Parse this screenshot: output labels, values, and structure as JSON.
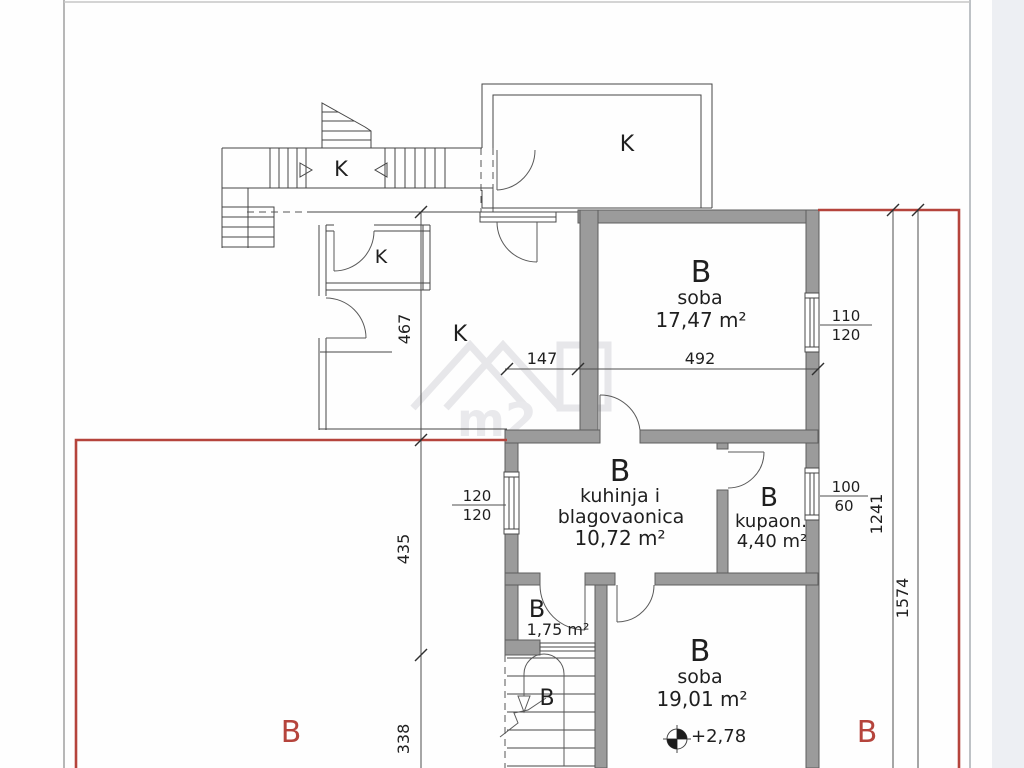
{
  "colors": {
    "red": "#b5443c",
    "wall_fill": "#9b9b9b",
    "line": "#454545"
  },
  "rooms": {
    "stair_hall": {
      "label": "K"
    },
    "k_small": {
      "label": "K"
    },
    "k_top": {
      "label": "K"
    },
    "k_main": {
      "label": "K"
    },
    "soba1": {
      "letter": "B",
      "name": "soba",
      "area": "17,47 m²"
    },
    "kitchen": {
      "letter": "B",
      "name_line1": "kuhinja i",
      "name_line2": "blagovaonica",
      "area": "10,72 m²"
    },
    "bath": {
      "letter": "B",
      "name": "kupaon.",
      "area": "4,40 m²"
    },
    "storage": {
      "letter": "B",
      "area": "1,75 m²"
    },
    "stair_lower": {
      "letter": "B"
    },
    "soba2": {
      "letter": "B",
      "name": "soba",
      "area": "19,01 m²"
    }
  },
  "dimensions": {
    "w147": "147",
    "w492": "492",
    "h467": "467",
    "h435": "435",
    "h338": "338",
    "h1241": "1241",
    "h1574": "1574",
    "win_soba": {
      "top": "110",
      "bottom": "120"
    },
    "win_kitchen": {
      "top": "120",
      "bottom": "120"
    },
    "win_bath": {
      "top": "100",
      "bottom": "60"
    }
  },
  "annotations": {
    "elevation": "+2,78",
    "section_label_left": "B",
    "section_label_right": "B",
    "watermark": "m2"
  }
}
